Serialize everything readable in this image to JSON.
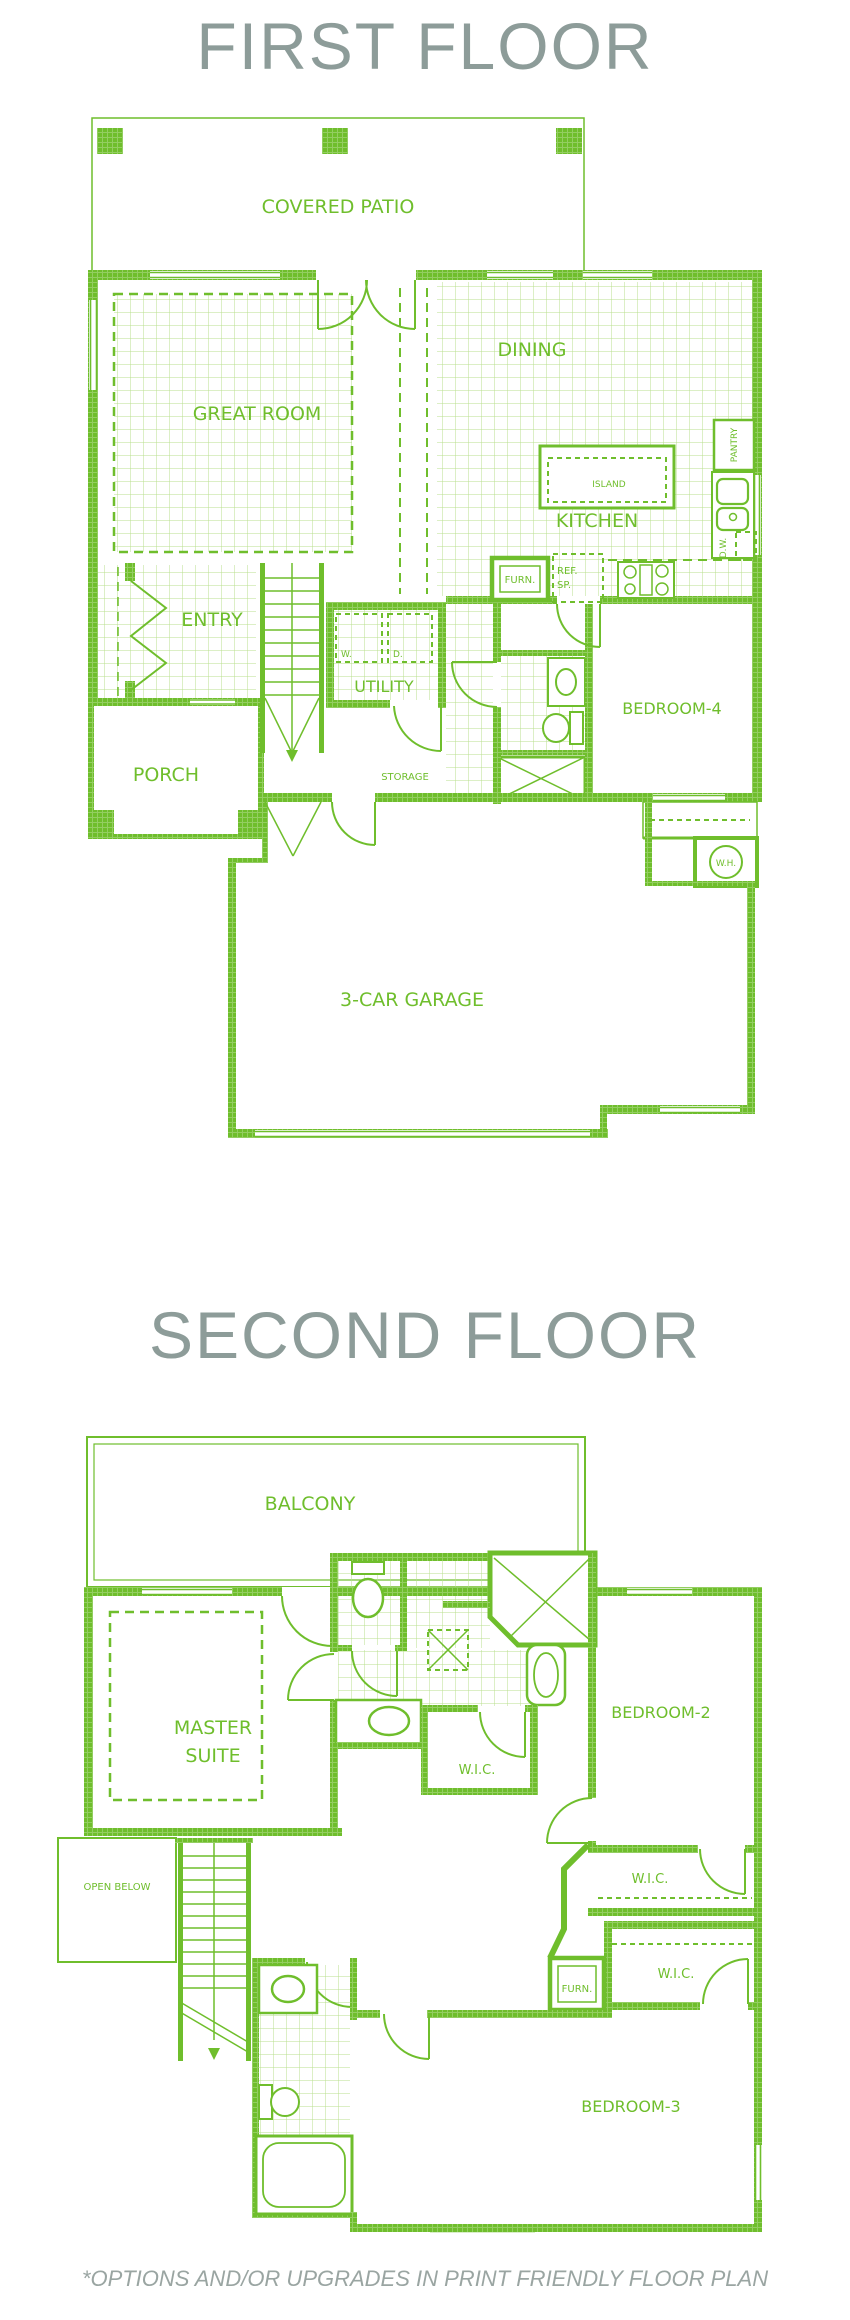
{
  "header": {
    "first": "FIRST FLOOR",
    "second": "SECOND FLOOR"
  },
  "footnote": "*OPTIONS AND/OR UPGRADES IN PRINT FRIENDLY FLOOR PLAN",
  "colors": {
    "plan_green": "#6fbe2c",
    "tile_green": "#b8df8e",
    "title_gray": "#8d9c99",
    "footnote_gray": "#9aa5a2"
  },
  "first_floor": {
    "covered_patio": "COVERED PATIO",
    "great_room": "GREAT ROOM",
    "dining": "DINING",
    "island": "ISLAND",
    "kitchen": "KITCHEN",
    "pantry": "PANTRY",
    "dishwasher": "D.W.",
    "ref_line1": "REF.",
    "ref_line2": "SP.",
    "furnace": "FURN.",
    "entry": "ENTRY",
    "utility": "UTILITY",
    "washer": "W.",
    "dryer": "D.",
    "porch": "PORCH",
    "storage": "STORAGE",
    "bedroom4": "BEDROOM-4",
    "water_heater": "W.H.",
    "garage": "3-CAR GARAGE"
  },
  "second_floor": {
    "balcony": "BALCONY",
    "master_line1": "MASTER",
    "master_line2": "SUITE",
    "bedroom2": "BEDROOM-2",
    "wic_master": "W.I.C.",
    "wic_bedroom2": "W.I.C.",
    "wic_bedroom3": "W.I.C.",
    "furnace": "FURN.",
    "open_below": "OPEN BELOW",
    "bedroom3": "BEDROOM-3"
  }
}
